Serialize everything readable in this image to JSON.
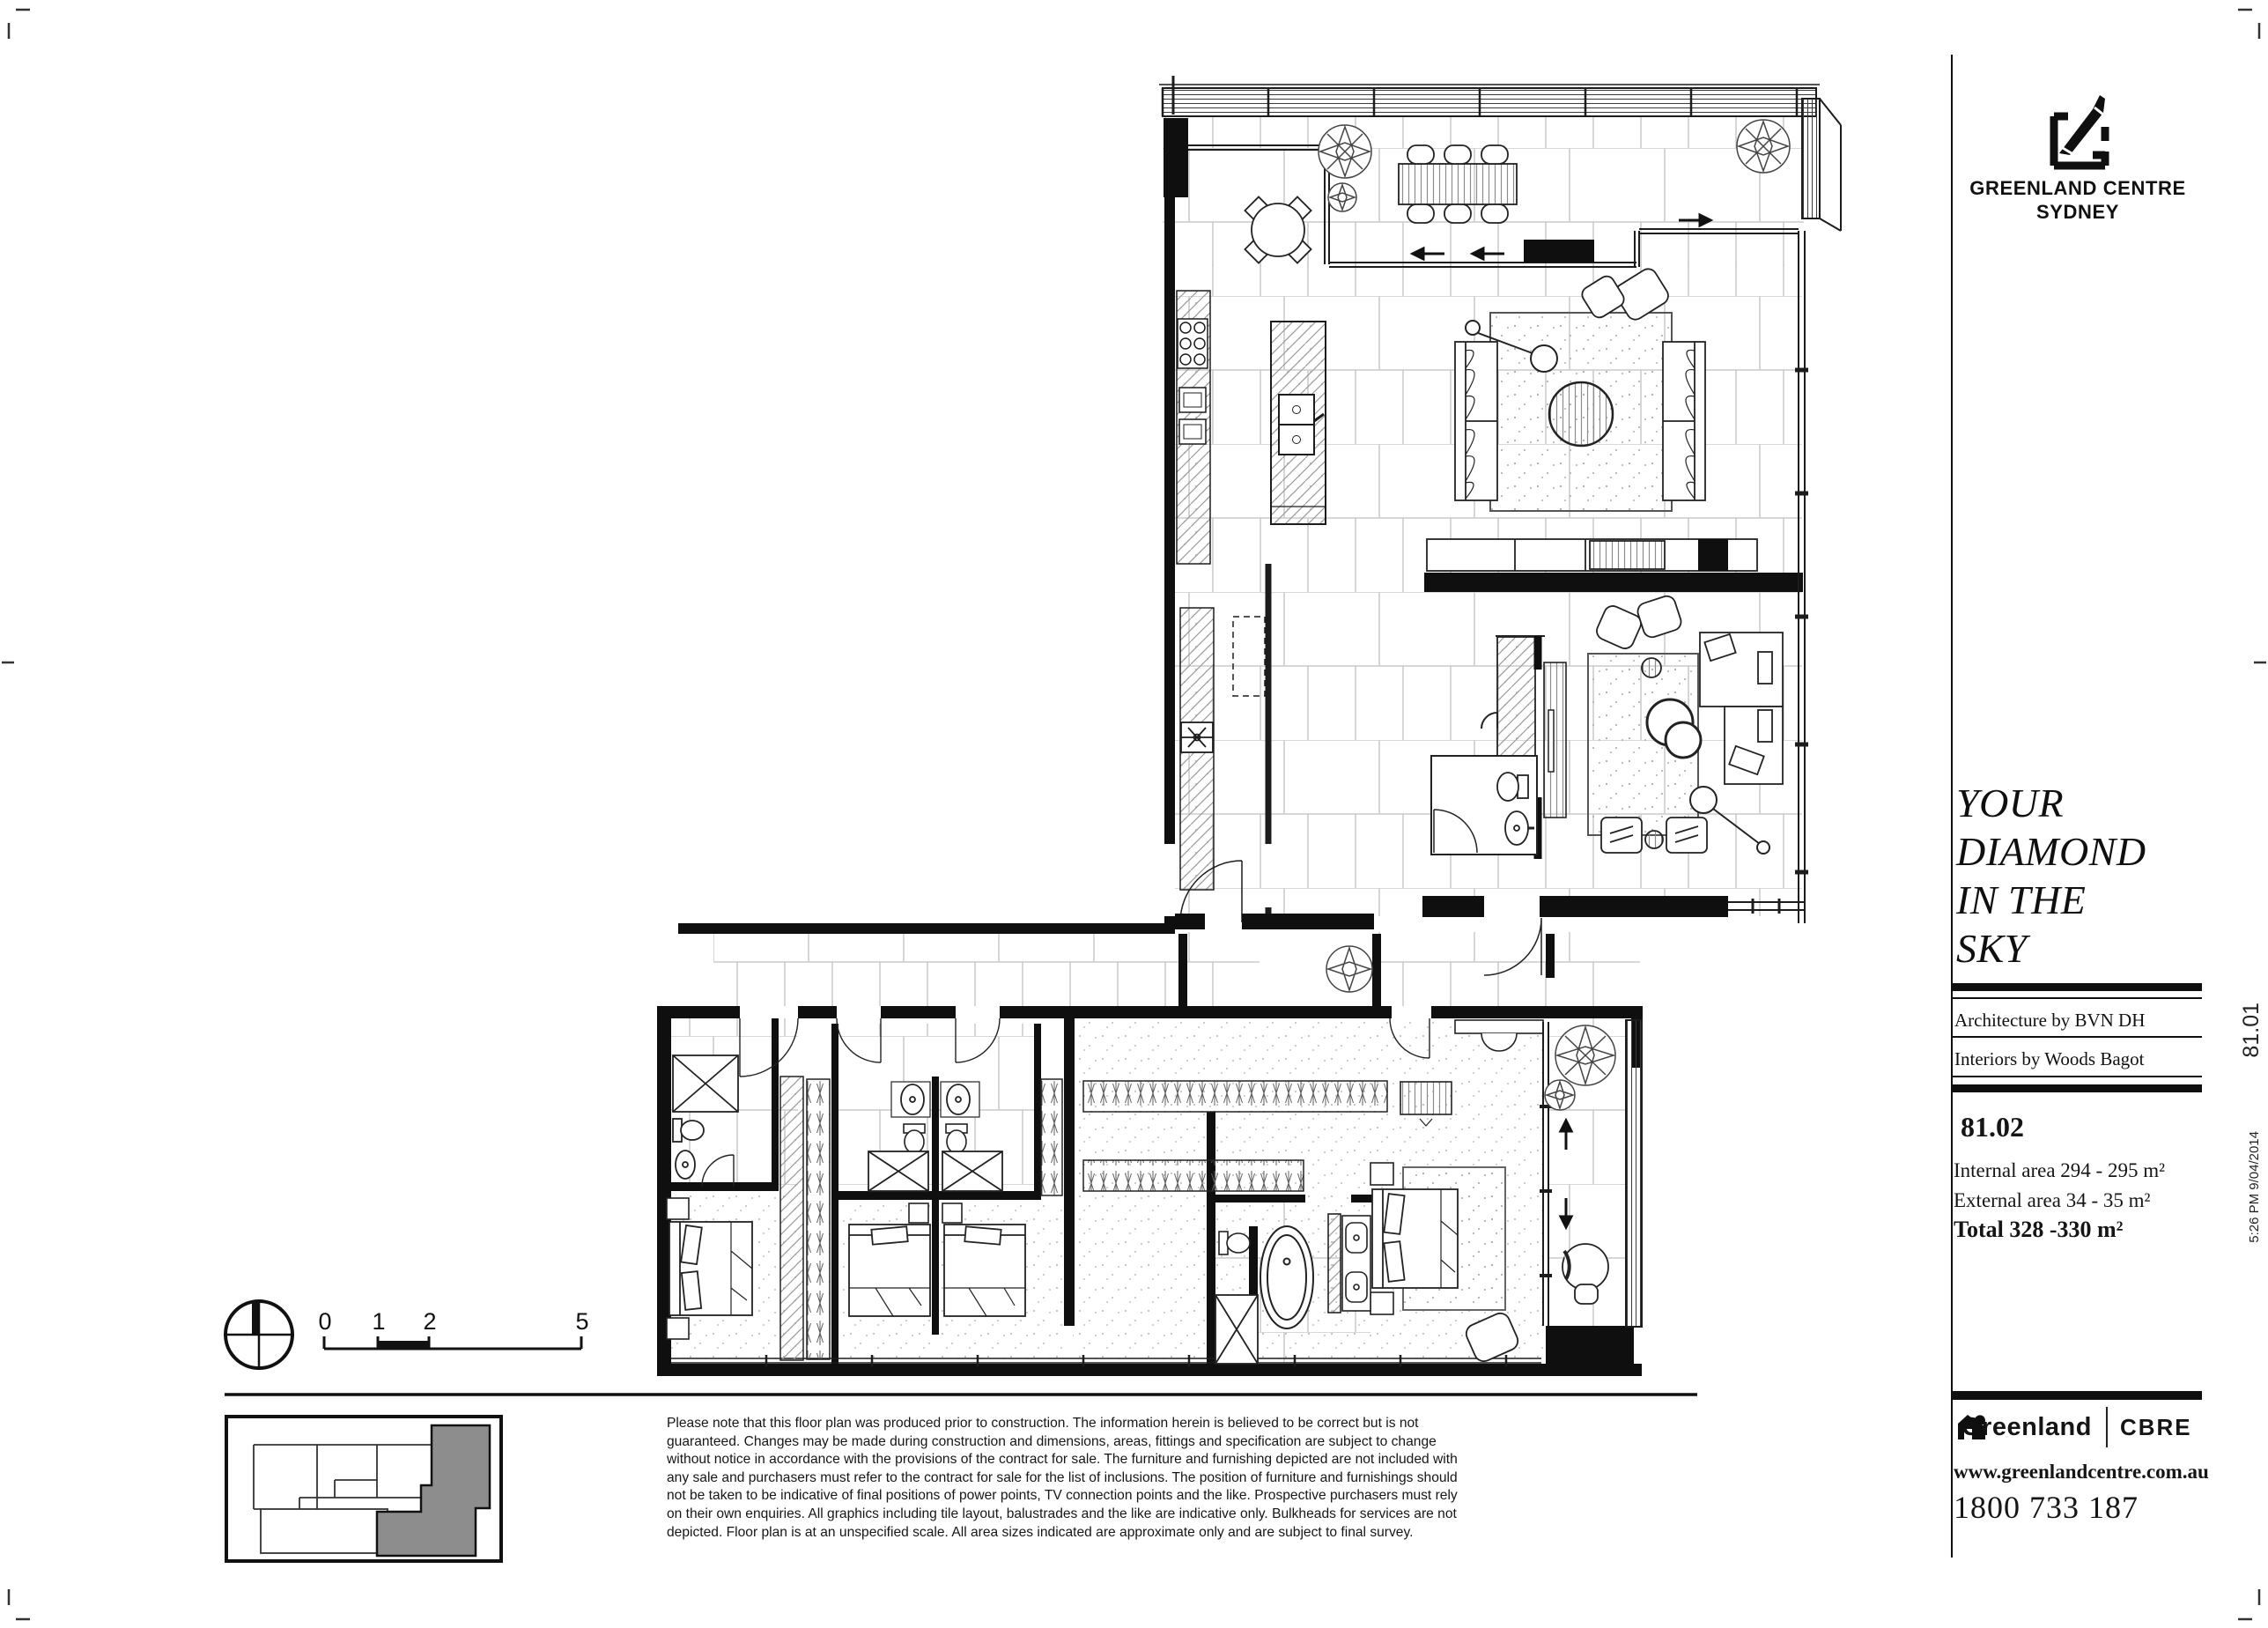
{
  "brand": {
    "line1": "GREENLAND CENTRE",
    "line2": "SYDNEY"
  },
  "tagline": {
    "l1": "YOUR",
    "l2": "DIAMOND",
    "l3": "IN THE",
    "l4": "SKY"
  },
  "credits": {
    "architecture": "Architecture by BVN DH",
    "interiors": "Interiors by Woods Bagot"
  },
  "unit": {
    "number": "81.02",
    "internal": "Internal area 294 - 295 m²",
    "external": "External area 34 - 35 m²",
    "total": "Total 328 -330 m²"
  },
  "contact": {
    "greenland": "Greenland",
    "cbre": "CBRE",
    "website": "www.greenlandcentre.com.au",
    "phone": "1800 733 187"
  },
  "stamps": {
    "sheet_ref": "81.01",
    "timestamp": "5:26 PM 9/04/2014"
  },
  "scalebar": {
    "t0": "0",
    "t1": "1",
    "t2": "2",
    "t5": "5"
  },
  "disclaimer": {
    "l1": "Please note that this floor plan was produced prior to construction. The information herein is believed to be correct but is not",
    "l2": "guaranteed. Changes may be made during construction and dimensions, areas, fittings and specification are subject to change",
    "l3": "without notice in accordance with the provisions of the contract for sale. The furniture and furnishing depicted are not included with",
    "l4": "any sale and purchasers must refer to the contract for sale for the list of inclusions. The position of furniture and furnishings should",
    "l5": "not be taken to be indicative of final positions of power points, TV connection points and the like. Prospective purchasers must rely",
    "l6": "on their own enquiries. All graphics including tile layout, balustrades and the like are indicative only. Bulkheads for services are not",
    "l7": "depicted. Floor plan is at an unspecified scale. All area sizes indicated are approximate only and are subject to final survey."
  },
  "colors": {
    "ink": "#111111",
    "unit_fill": "#8d8d8d",
    "tile_line": "#cccccc"
  }
}
